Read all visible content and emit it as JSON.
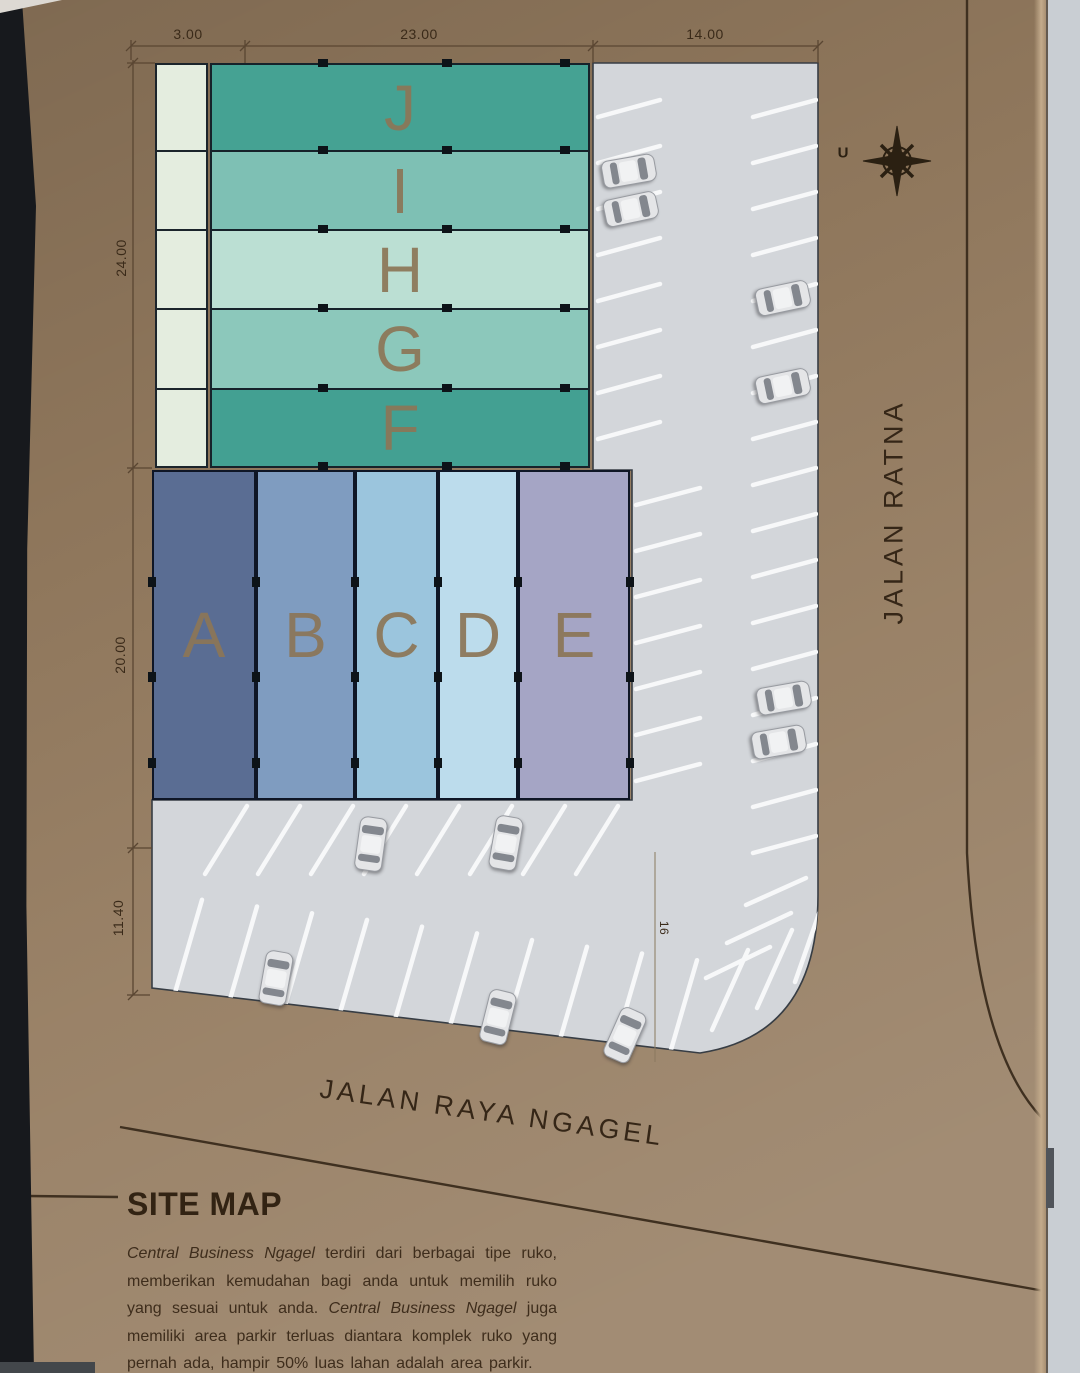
{
  "map": {
    "north_label": "U",
    "streets": {
      "right": "JALAN RATNA",
      "bottom": "JALAN RAYA NGAGEL"
    },
    "dimensions": {
      "top": [
        "3.00",
        "23.00",
        "14.00"
      ],
      "left": [
        "24.00",
        "20.00",
        "11.40"
      ],
      "parking_width": "16"
    },
    "blocks": {
      "green_rows": [
        {
          "label": "J",
          "color": "#45a293"
        },
        {
          "label": "I",
          "color": "#7ec0b4"
        },
        {
          "label": "H",
          "color": "#bbdfd3"
        },
        {
          "label": "G",
          "color": "#8cc8bb"
        },
        {
          "label": "F",
          "color": "#43a092"
        }
      ],
      "side_strip_color": "#e4eddf",
      "blue_columns": [
        {
          "label": "A",
          "color": "#5a6d93"
        },
        {
          "label": "B",
          "color": "#7f9cc0"
        },
        {
          "label": "C",
          "color": "#9bc5dd"
        },
        {
          "label": "D",
          "color": "#bcdcec"
        },
        {
          "label": "E",
          "color": "#a5a5c5"
        }
      ]
    }
  },
  "caption": {
    "heading": "SITE MAP",
    "description_parts": [
      {
        "text": "Central Business Ngagel",
        "italic": true
      },
      {
        "text": " terdiri dari berbagai tipe ruko, memberikan kemudahan bagi anda untuk memilih ruko yang sesuai untuk anda. ",
        "italic": false
      },
      {
        "text": "Central Business Ngagel",
        "italic": true
      },
      {
        "text": " juga memiliki area parkir terluas diantara komplek ruko yang pernah ada, hampir 50% luas lahan adalah area parkir.",
        "italic": false
      }
    ]
  },
  "colors": {
    "paper": "#947b5f",
    "ink": "#3a2a19",
    "block_letter": "#8c7657",
    "parking_asphalt": "#d3d6da",
    "parking_stripe": "#f7f8f9",
    "compass": "#2b2012"
  }
}
